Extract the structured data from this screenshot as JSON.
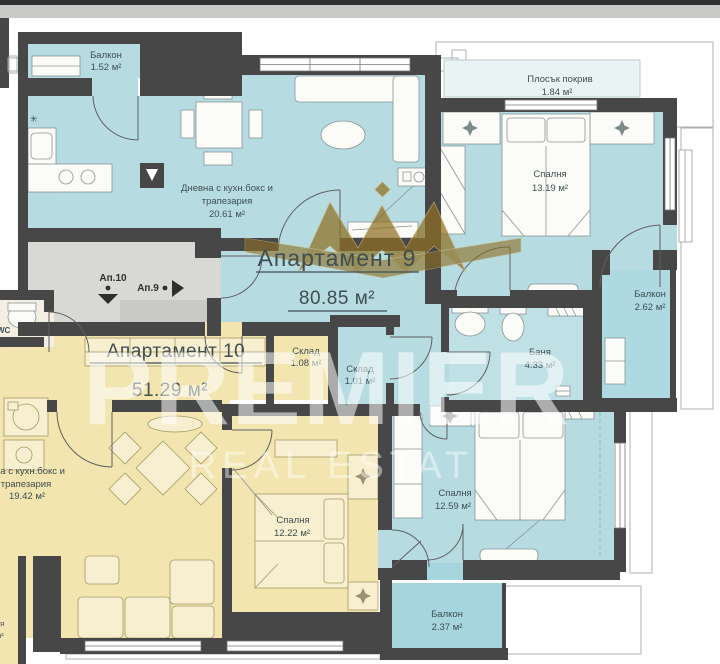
{
  "colors": {
    "wall": "#474747",
    "apartment9_fill": "#b6dce2",
    "apartment10_fill": "#f2e5b0",
    "corridor_fill": "#d8d8d4",
    "balcony_fill": "#a8d7de",
    "flat_roof_fill": "#e9f3f4",
    "watermark_gold": "#8f6f24",
    "label_text": "#3e4e51"
  },
  "watermark": {
    "brand": "PREMIER",
    "tagline": "REAL ESTATE"
  },
  "flat_roof": {
    "name": "Плосък покрив",
    "area": "1.84 м²"
  },
  "apartment9": {
    "title": "Апартамент 9",
    "area": "80.85 м²",
    "rooms": {
      "balcony_top": {
        "name": "Балкон",
        "area": "1.52 м²"
      },
      "living": {
        "line1": "Дневна с кухн.бокс и",
        "line2": "трапезария",
        "area": "20.61 м²"
      },
      "bedroom_top": {
        "name": "Спалня",
        "area": "13.19 м²"
      },
      "balcony_right": {
        "name": "Балкон",
        "area": "2.62 м²"
      },
      "storage": {
        "name": "Склад",
        "area": "1.01 м²"
      },
      "bath": {
        "name": "Баня",
        "area": "4.33 м²"
      },
      "bedroom_bottom": {
        "name": "Спалня",
        "area": "12.59 м²"
      },
      "balcony_bottom": {
        "name": "Балкон",
        "area": "2.37 м²"
      }
    }
  },
  "apartment10": {
    "title": "Апартамент 10",
    "area": "51.29 м²",
    "rooms": {
      "storage": {
        "name": "Склад",
        "area": "1.08 м²"
      },
      "living": {
        "line1": "на с кухн.бокс и",
        "line2": "трапезария",
        "area": "19.42 м²"
      },
      "bedroom": {
        "name": "Спалня",
        "area": "12.22 м²"
      },
      "wc": {
        "name": "WC"
      }
    }
  },
  "common": {
    "ap10": "Ап.10",
    "ap9": "Ап.9"
  },
  "fragments": {
    "wc_area": "м²",
    "left_edge_top": "ня",
    "left_edge_bottom": "м²"
  }
}
